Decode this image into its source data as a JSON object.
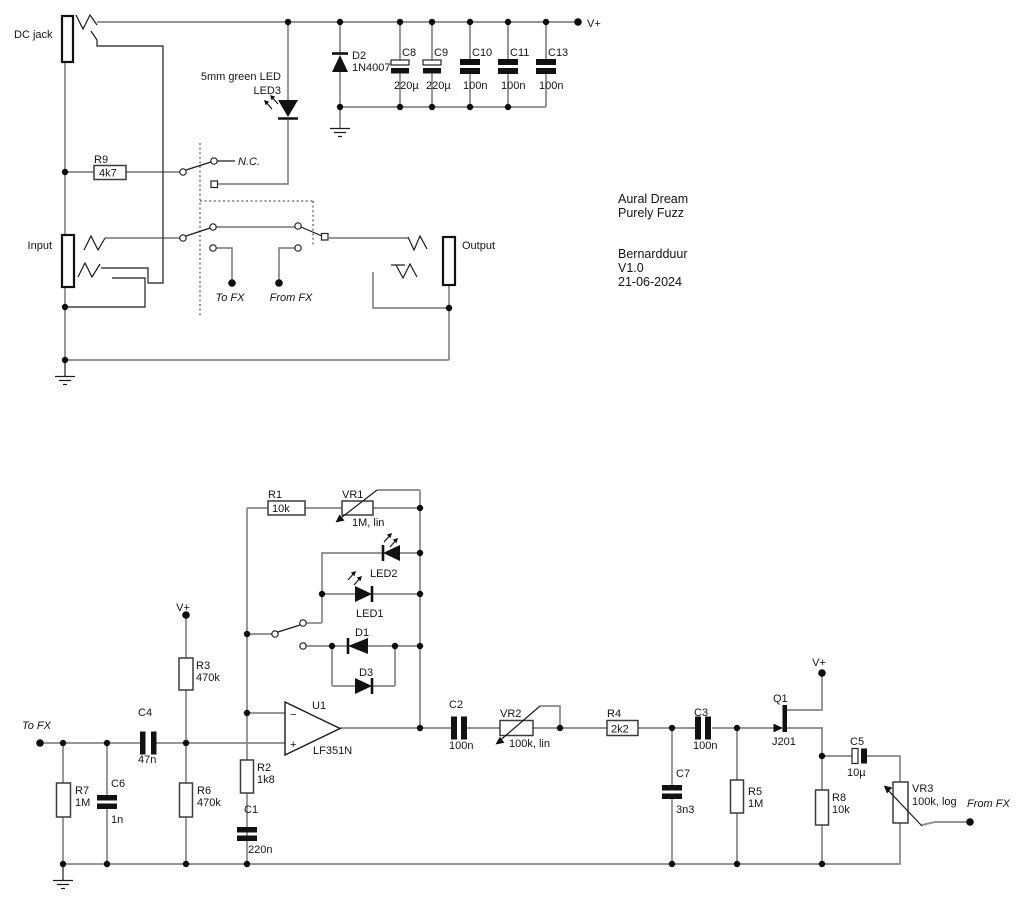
{
  "title_block": {
    "maker": "Aural Dream",
    "model": "Purely Fuzz",
    "author": "Bernardduur",
    "version": "V1.0",
    "date": "21-06-2024"
  },
  "labels": {
    "vplus": "V+",
    "dc_jack": "DC jack",
    "input": "Input",
    "output": "Output",
    "nc": "N.C.",
    "to_fx": "To FX",
    "from_fx": "From FX",
    "led3_note": "5mm green LED"
  },
  "components": {
    "R9": {
      "ref": "R9",
      "value": "4k7"
    },
    "D2": {
      "ref": "D2",
      "value": "1N4007"
    },
    "LED3": {
      "ref": "LED3"
    },
    "C8": {
      "ref": "C8",
      "value": "220µ"
    },
    "C9": {
      "ref": "C9",
      "value": "220µ"
    },
    "C10": {
      "ref": "C10",
      "value": "100n"
    },
    "C11": {
      "ref": "C11",
      "value": "100n"
    },
    "C13": {
      "ref": "C13",
      "value": "100n"
    },
    "R1": {
      "ref": "R1",
      "value": "10k"
    },
    "VR1": {
      "ref": "VR1",
      "value": "1M, lin"
    },
    "LED2": {
      "ref": "LED2"
    },
    "LED1": {
      "ref": "LED1"
    },
    "D1": {
      "ref": "D1"
    },
    "D3": {
      "ref": "D3"
    },
    "R3": {
      "ref": "R3",
      "value": "470k"
    },
    "R6": {
      "ref": "R6",
      "value": "470k"
    },
    "R7": {
      "ref": "R7",
      "value": "1M"
    },
    "C6": {
      "ref": "C6",
      "value": "1n"
    },
    "C4": {
      "ref": "C4",
      "value": "47n"
    },
    "R2": {
      "ref": "R2",
      "value": "1k8"
    },
    "C1": {
      "ref": "C1",
      "value": "220n"
    },
    "U1": {
      "ref": "U1",
      "value": "LF351N",
      "minus": "−",
      "plus": "+"
    },
    "C2": {
      "ref": "C2",
      "value": "100n"
    },
    "VR2": {
      "ref": "VR2",
      "value": "100k, lin"
    },
    "R4": {
      "ref": "R4",
      "value": "2k2"
    },
    "C7": {
      "ref": "C7",
      "value": "3n3"
    },
    "C3": {
      "ref": "C3",
      "value": "100n"
    },
    "R5": {
      "ref": "R5",
      "value": "1M"
    },
    "Q1": {
      "ref": "Q1",
      "value": "J201"
    },
    "R8": {
      "ref": "R8",
      "value": "10k"
    },
    "C5": {
      "ref": "C5",
      "value": "10µ"
    },
    "VR3": {
      "ref": "VR3",
      "value": "100k, log"
    }
  }
}
